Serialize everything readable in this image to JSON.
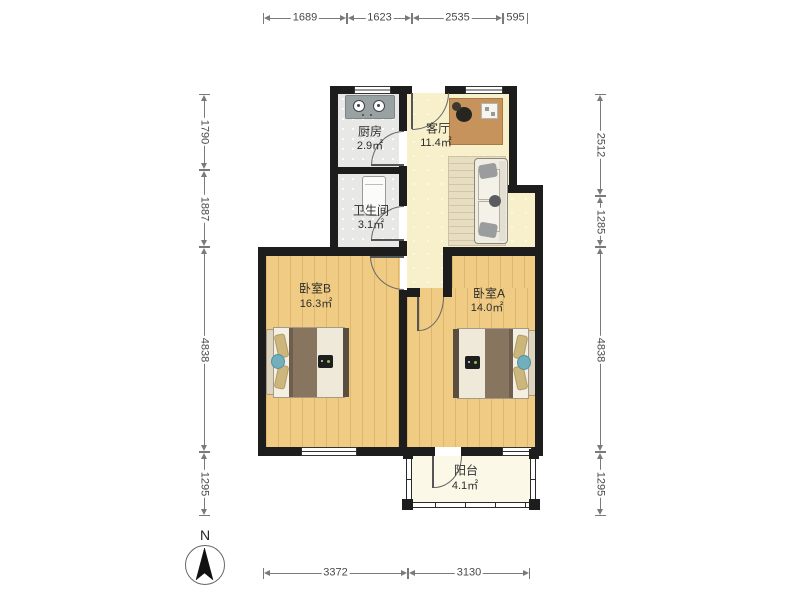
{
  "dimensions": {
    "top": [
      "1689",
      "1623",
      "2535",
      "595"
    ],
    "left": [
      "1790",
      "1887",
      "4838",
      "1295"
    ],
    "right": [
      "2512",
      "1285",
      "4838",
      "1295"
    ],
    "bottom": [
      "3372",
      "3130"
    ]
  },
  "rooms": [
    {
      "id": "kitchen",
      "name": "厨房",
      "area": "2.9㎡"
    },
    {
      "id": "living",
      "name": "客厅",
      "area": "11.4㎡"
    },
    {
      "id": "bathroom",
      "name": "卫生间",
      "area": "3.1㎡"
    },
    {
      "id": "bedroomB",
      "name": "卧室B",
      "area": "16.3㎡"
    },
    {
      "id": "bedroomA",
      "name": "卧室A",
      "area": "14.0㎡"
    },
    {
      "id": "balcony",
      "name": "阳台",
      "area": "4.1㎡"
    }
  ],
  "compass": {
    "label": "N"
  },
  "colors": {
    "wall": "#1d1d1d",
    "floor_wood": "#f0cb83",
    "floor_tile": "#e8e9e7",
    "floor_living": "#f7f0cb",
    "floor_balcony": "#fbf8e8",
    "blanket": "#87755f",
    "accent_teal": "#72aebc"
  }
}
